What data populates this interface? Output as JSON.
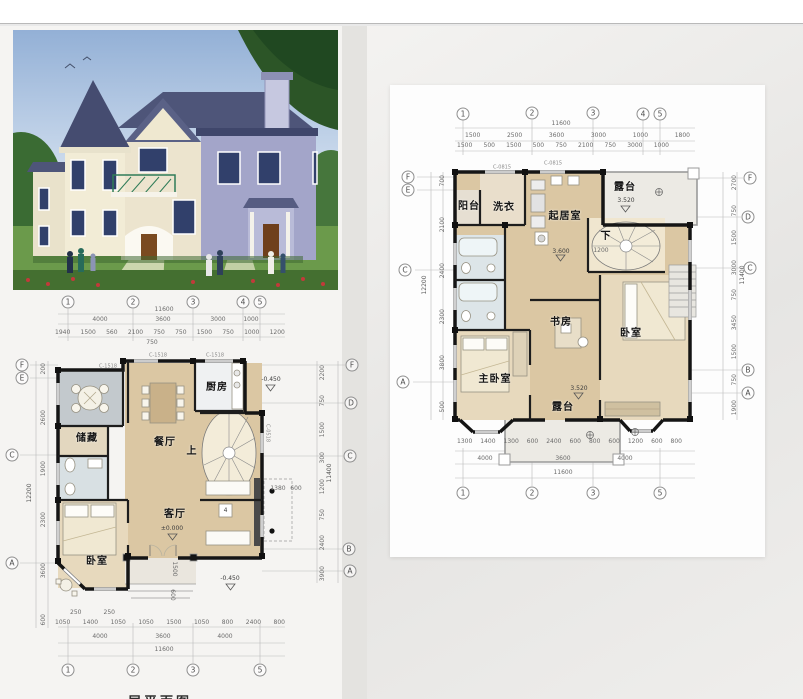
{
  "colors": {
    "roof": "#4a5070",
    "wall_cream": "#f1ead3",
    "wall_lavender": "#9fa1c8",
    "sky": "#9db9da",
    "grass": "#5f9140",
    "plan_floor": "#dbc7a3",
    "plan_wall": "#151515",
    "panel_bg": "#fdfdfd",
    "page_gray": "#e6e5e3"
  },
  "photo": {
    "subject": "two-story villa exterior rendering"
  },
  "first_floor": {
    "caption": "一层平面图",
    "grid_top": [
      "1",
      "2",
      "3",
      "4",
      "5"
    ],
    "grid_bottom": [
      "1",
      "2",
      "3",
      "5"
    ],
    "grid_left": [
      "F",
      "E",
      "C",
      "A"
    ],
    "grid_right": [
      "F",
      "D",
      "C",
      "B",
      "A"
    ],
    "dim_overall_top": "11600",
    "dims_top_major": [
      "4000",
      "3600",
      "3000",
      "1000"
    ],
    "dims_top_minor": [
      "1940",
      "1500",
      "560",
      "2100",
      "750",
      "750",
      "1500",
      "750",
      "1000",
      "1200"
    ],
    "dim_top_extra": "750",
    "dims_bottom_small": [
      "250",
      "250"
    ],
    "dims_bottom_minor": [
      "1050",
      "1400",
      "1050",
      "1050",
      "1500",
      "1050",
      "800",
      "2400",
      "800"
    ],
    "dims_bottom_major": [
      "4000",
      "3600",
      "4000"
    ],
    "dim_overall_bottom": "11600",
    "dims_left": [
      "200",
      "2600",
      "1900",
      "2300",
      "3600",
      "600"
    ],
    "dim_overall_left": "12200",
    "dims_right": [
      "2200",
      "750",
      "1500",
      "300",
      "1200",
      "750",
      "2400",
      "3900"
    ],
    "dim_overall_right": "11400",
    "dims_porch": [
      "1380",
      "600"
    ],
    "dim_porch_depth": "1500",
    "dim_porch_step": "600",
    "rooms": {
      "kitchen": "厨房",
      "dining": "餐厅",
      "storage": "储藏",
      "living": "客厅",
      "bedroom": "卧室",
      "stair": "上"
    },
    "elevations": {
      "living": "±0.000",
      "entry": "-0.450",
      "kitchen_out": "-0.450"
    },
    "marker": "4",
    "window_tags": [
      "C-1518",
      "C-1518",
      "C-1518",
      "C-0518"
    ]
  },
  "second_floor": {
    "grid_top": [
      "1",
      "2",
      "3",
      "4",
      "5"
    ],
    "grid_bottom": [
      "1",
      "2",
      "3",
      "5"
    ],
    "grid_left": [
      "F",
      "E",
      "C",
      "A"
    ],
    "grid_right": [
      "F",
      "D",
      "C",
      "B",
      "A"
    ],
    "dim_overall_top": "11600",
    "dims_top_major": [
      "1500",
      "2500",
      "3600",
      "3000",
      "1000",
      "1800"
    ],
    "dims_top_minor": [
      "1500",
      "500",
      "1500",
      "500",
      "750",
      "2100",
      "750",
      "3000",
      "1000"
    ],
    "dims_bottom_minor": [
      "1300",
      "1400",
      "1300",
      "600",
      "2400",
      "600",
      "800",
      "600",
      "1200",
      "600",
      "800"
    ],
    "dims_bottom_major": [
      "4000",
      "3600",
      "4000"
    ],
    "dim_overall_bottom": "11600",
    "dims_left": [
      "700",
      "2100",
      "2400",
      "2300",
      "3800",
      "500"
    ],
    "dim_overall_left": "12200",
    "dims_right": [
      "2700",
      "750",
      "1500",
      "3000",
      "750",
      "3450",
      "1500",
      "750",
      "1900"
    ],
    "dim_overall_right": "11400",
    "dim_stair": "1200",
    "rooms": {
      "balcony": "阳台",
      "laundry": "洗衣",
      "family": "起居室",
      "terrace_top": "露台",
      "stair": "下",
      "study": "书房",
      "bedroom": "卧室",
      "master": "主卧室",
      "terrace_bottom": "露台"
    },
    "elevations": {
      "floor": "3.600",
      "terrace_top": "3.520",
      "terrace_bottom": "3.520"
    },
    "window_tags": [
      "C-0815",
      "C-0815"
    ]
  }
}
